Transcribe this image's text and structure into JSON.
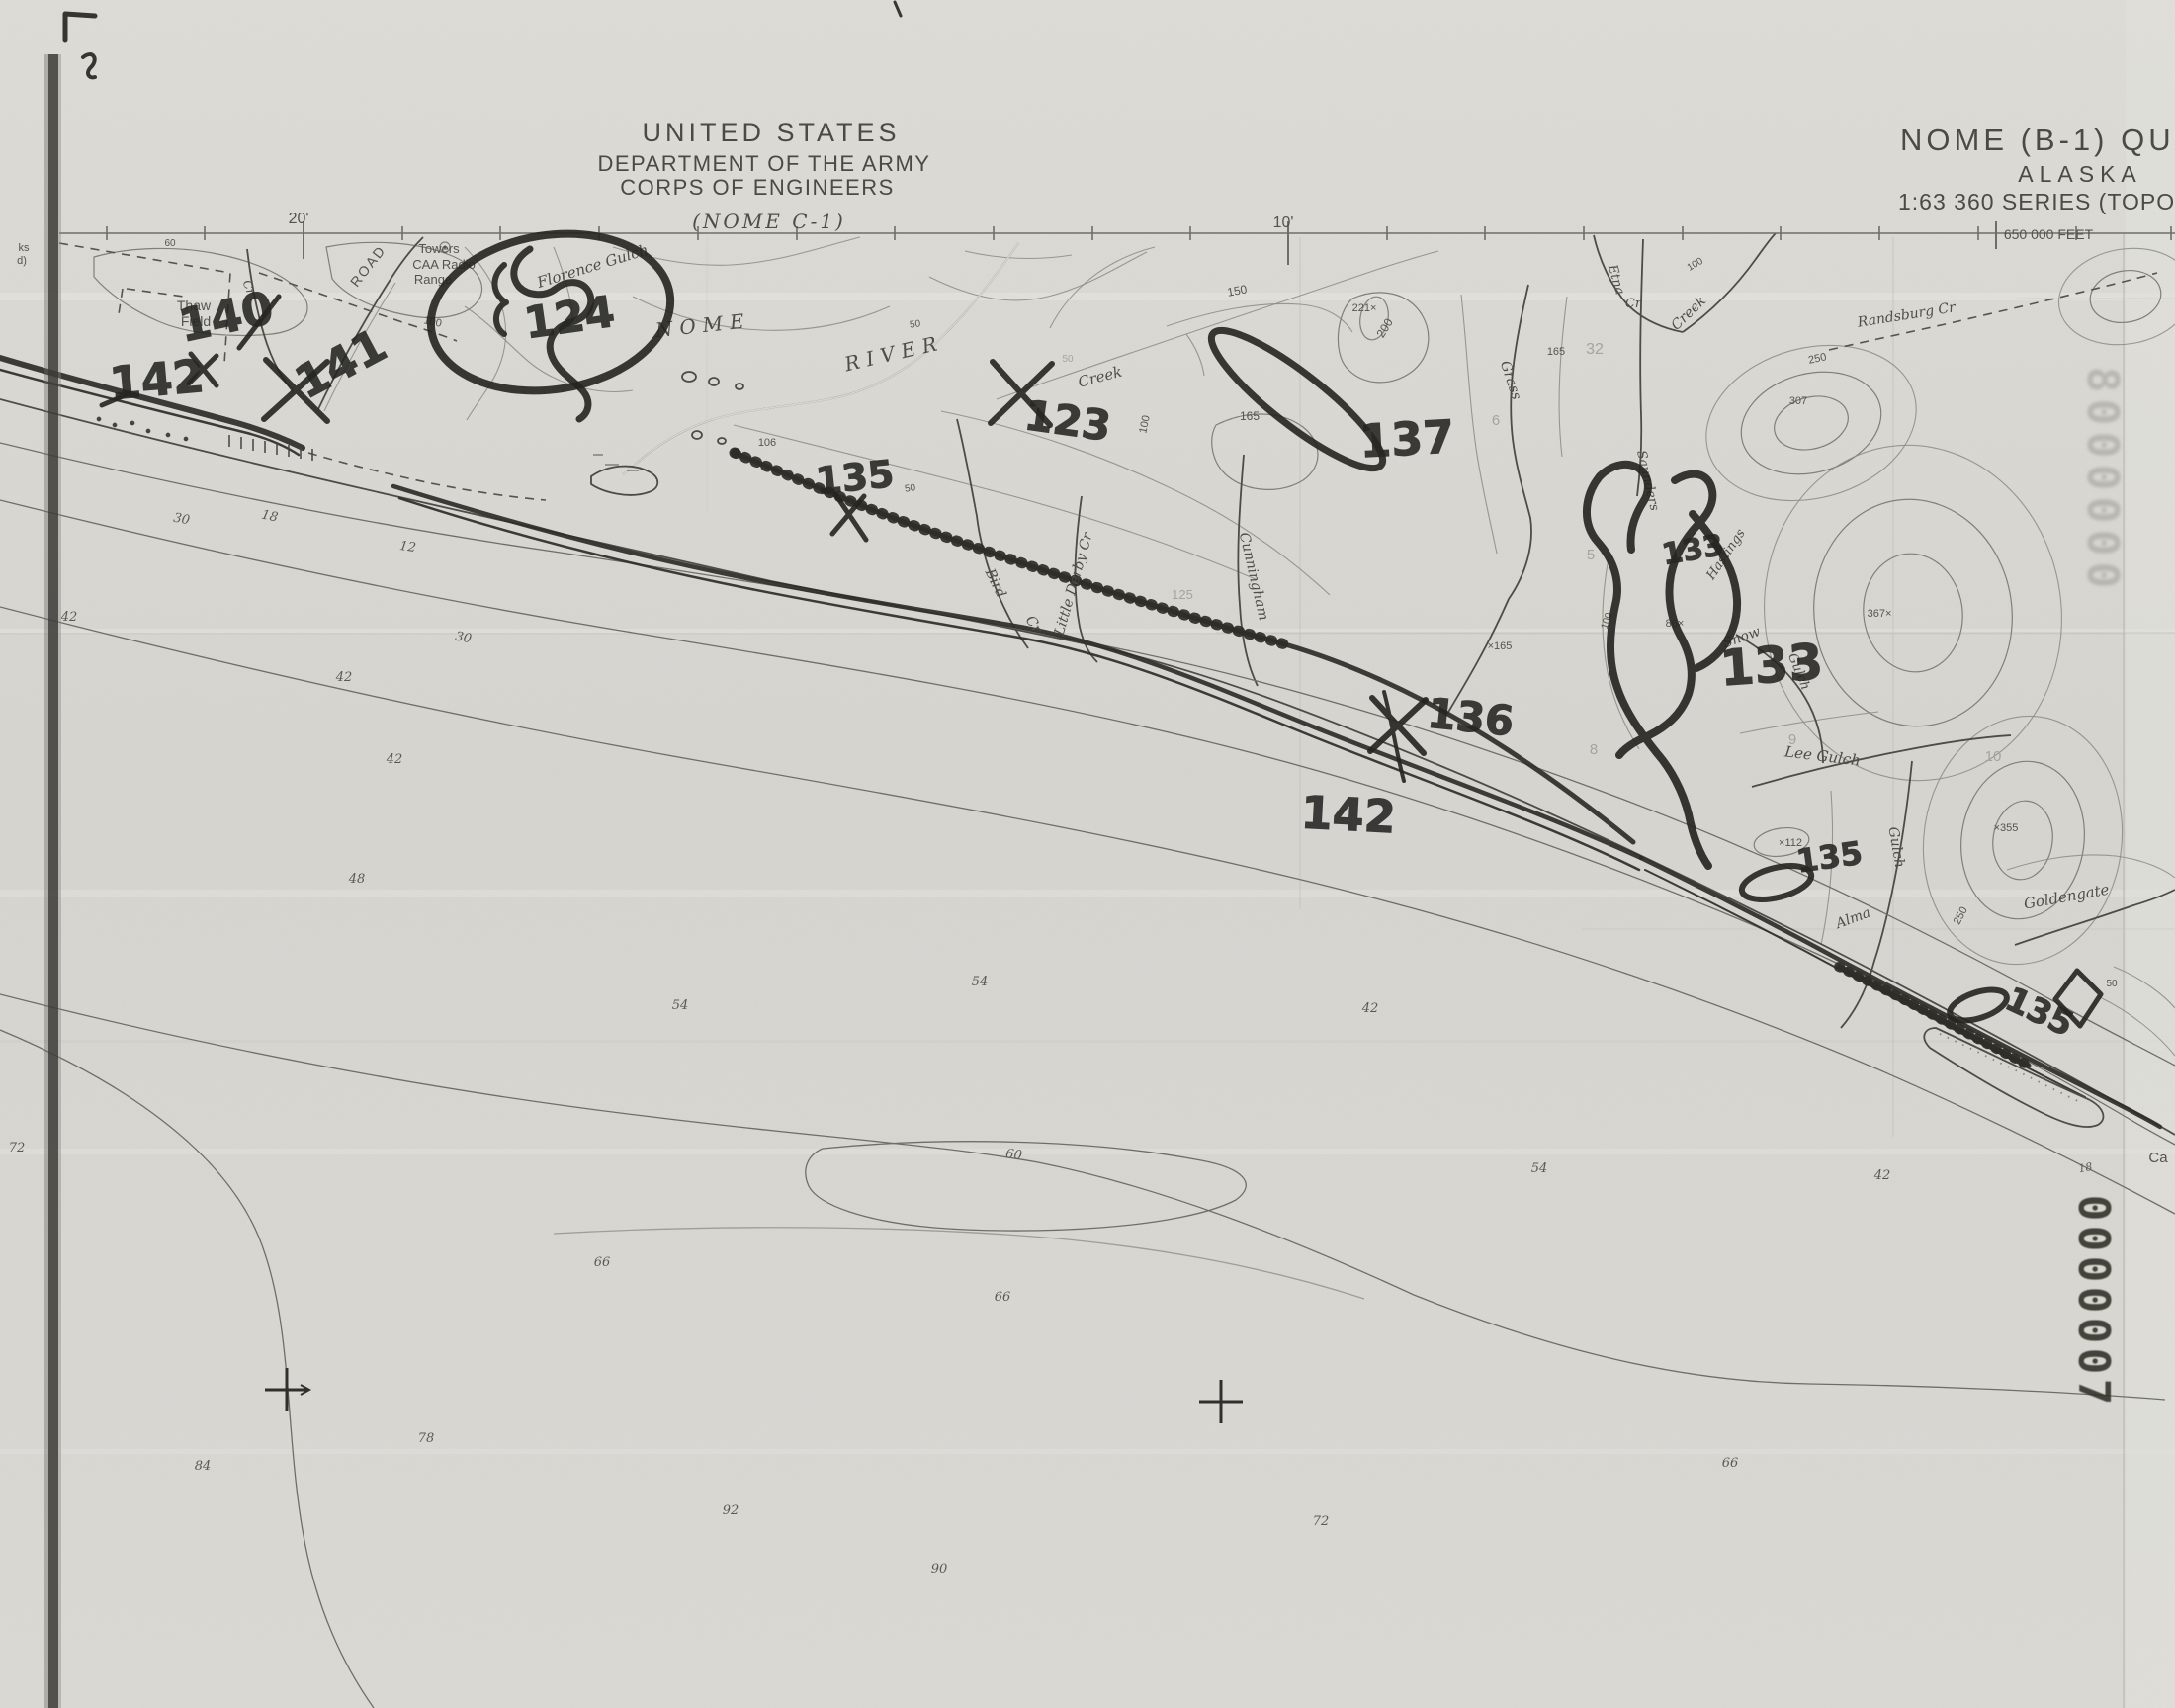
{
  "header": {
    "line1": "UNITED STATES",
    "line2": "DEPARTMENT OF THE ARMY",
    "line3": "CORPS OF ENGINEERS",
    "sheet_ref": "(NOME C-1)"
  },
  "title_block": {
    "quad": "NOME (B-1) QUADRA",
    "state": "ALASKA",
    "series": "1:63 360 SERIES (TOPOG",
    "feet_note": "650 000 FEET"
  },
  "neatline": {
    "tick_20": "20'",
    "tick_10": "10'"
  },
  "stamps": {
    "upper_faint": "8000000",
    "lower_dark": "0000007"
  },
  "colors": {
    "paper": "#dad9d4",
    "print_ink": "#55534c",
    "pen_ink": "#23221e",
    "faint": "#a6a59c"
  },
  "hand_annotations": [
    {
      "t": "140",
      "x": 232,
      "y": 336,
      "s": 46,
      "r": -12
    },
    {
      "t": "141",
      "x": 352,
      "y": 382,
      "s": 46,
      "r": -28
    },
    {
      "t": "142",
      "x": 160,
      "y": 400,
      "s": 46,
      "r": -5
    },
    {
      "t": "124",
      "x": 578,
      "y": 336,
      "s": 44,
      "r": -8
    },
    {
      "t": "135",
      "x": 866,
      "y": 496,
      "s": 38,
      "r": -6
    },
    {
      "t": "123",
      "x": 1078,
      "y": 440,
      "s": 42,
      "r": 8
    },
    {
      "t": "137",
      "x": 1424,
      "y": 460,
      "s": 46,
      "r": -3
    },
    {
      "t": "133",
      "x": 1714,
      "y": 566,
      "s": 30,
      "r": -10
    },
    {
      "t": "133",
      "x": 1793,
      "y": 690,
      "s": 50,
      "r": -4
    },
    {
      "t": "136",
      "x": 1486,
      "y": 740,
      "s": 42,
      "r": 6
    },
    {
      "t": "142",
      "x": 1363,
      "y": 840,
      "s": 46,
      "r": 3
    },
    {
      "t": "135",
      "x": 1852,
      "y": 878,
      "s": 32,
      "r": -8
    },
    {
      "t": "135",
      "x": 2058,
      "y": 1034,
      "s": 34,
      "r": 25
    }
  ],
  "map_labels": [
    {
      "t": "Thaw",
      "x": 196,
      "y": 314,
      "s": 14
    },
    {
      "t": "Field",
      "x": 198,
      "y": 330,
      "s": 14
    },
    {
      "t": "ROAD",
      "x": 376,
      "y": 272,
      "s": 14,
      "r": -52,
      "ls": 2
    },
    {
      "t": "Towers",
      "x": 444,
      "y": 256,
      "s": 13
    },
    {
      "t": "CAA Radio",
      "x": 449,
      "y": 272,
      "s": 13
    },
    {
      "t": "Range",
      "x": 438,
      "y": 287,
      "s": 13
    },
    {
      "t": "100",
      "x": 437,
      "y": 329,
      "s": 11,
      "r": 12
    },
    {
      "t": "Florence Gulch",
      "x": 601,
      "y": 274,
      "s": 15,
      "r": -17,
      "c": "ser"
    },
    {
      "t": "NOME",
      "x": 712,
      "y": 336,
      "s": 20,
      "r": -6,
      "c": "ser",
      "ls": 7
    },
    {
      "t": "RIVER",
      "x": 906,
      "y": 364,
      "s": 20,
      "r": -13,
      "c": "ser",
      "ls": 7
    },
    {
      "t": "Creek",
      "x": 1114,
      "y": 386,
      "s": 15,
      "r": -15,
      "c": "ser"
    },
    {
      "t": "106",
      "x": 776,
      "y": 451,
      "s": 11
    },
    {
      "t": "50",
      "x": 926,
      "y": 331,
      "s": 10,
      "r": -8
    },
    {
      "t": "50",
      "x": 921,
      "y": 497,
      "s": 10,
      "r": -8
    },
    {
      "t": "50",
      "x": 1080,
      "y": 366,
      "s": 10,
      "c": "fnt"
    },
    {
      "t": "100",
      "x": 1161,
      "y": 430,
      "s": 11,
      "r": -78
    },
    {
      "t": "Bird",
      "x": 1003,
      "y": 592,
      "s": 14,
      "r": 64,
      "c": "ser"
    },
    {
      "t": "Cr",
      "x": 1042,
      "y": 634,
      "s": 14,
      "r": 55,
      "c": "ser"
    },
    {
      "t": "Little Derby Cr",
      "x": 1090,
      "y": 592,
      "s": 14,
      "r": -74,
      "c": "ser"
    },
    {
      "t": "Cunningham",
      "x": 1264,
      "y": 584,
      "s": 14,
      "r": 77,
      "c": "ser"
    },
    {
      "t": "125",
      "x": 1196,
      "y": 606,
      "s": 13,
      "c": "fnt"
    },
    {
      "t": "150",
      "x": 1252,
      "y": 298,
      "s": 12,
      "r": -10
    },
    {
      "t": "221×",
      "x": 1380,
      "y": 315,
      "s": 11
    },
    {
      "t": "200",
      "x": 1404,
      "y": 334,
      "s": 12,
      "r": -58
    },
    {
      "t": "165",
      "x": 1264,
      "y": 425,
      "s": 12
    },
    {
      "t": "Grass",
      "x": 1524,
      "y": 386,
      "s": 14,
      "r": 72,
      "c": "ser"
    },
    {
      "t": "165",
      "x": 1574,
      "y": 359,
      "s": 11
    },
    {
      "t": "32",
      "x": 1613,
      "y": 358,
      "s": 16,
      "c": "fnt"
    },
    {
      "t": "×165",
      "x": 1517,
      "y": 657,
      "s": 11
    },
    {
      "t": "Etna",
      "x": 1631,
      "y": 284,
      "s": 13,
      "r": 74,
      "c": "ser"
    },
    {
      "t": "Cr",
      "x": 1652,
      "y": 311,
      "s": 13,
      "c": "ser"
    },
    {
      "t": "Creek",
      "x": 1711,
      "y": 320,
      "s": 14,
      "r": -44,
      "c": "ser"
    },
    {
      "t": "100",
      "x": 1716,
      "y": 270,
      "s": 10,
      "r": -30
    },
    {
      "t": "Randsburg Cr",
      "x": 1929,
      "y": 323,
      "s": 14,
      "r": -9,
      "c": "ser"
    },
    {
      "t": "250",
      "x": 1839,
      "y": 366,
      "s": 11,
      "r": -12
    },
    {
      "t": "307",
      "x": 1819,
      "y": 409,
      "s": 11
    },
    {
      "t": "Saunders",
      "x": 1663,
      "y": 487,
      "s": 13,
      "r": 77,
      "c": "ser"
    },
    {
      "t": "Hastings",
      "x": 1749,
      "y": 563,
      "s": 13,
      "r": -56,
      "c": "ser"
    },
    {
      "t": "86×",
      "x": 1694,
      "y": 634,
      "s": 11
    },
    {
      "t": "100",
      "x": 1628,
      "y": 629,
      "s": 10,
      "r": -72
    },
    {
      "t": "367×",
      "x": 1901,
      "y": 624,
      "s": 11
    },
    {
      "t": "Snow",
      "x": 1763,
      "y": 649,
      "s": 14,
      "r": -20,
      "c": "ser"
    },
    {
      "t": "Gulch",
      "x": 1816,
      "y": 681,
      "s": 13,
      "r": 68,
      "c": "ser"
    },
    {
      "t": "Lee Gulch",
      "x": 1843,
      "y": 770,
      "s": 15,
      "r": 7,
      "c": "ser"
    },
    {
      "t": "Gulch",
      "x": 1914,
      "y": 858,
      "s": 14,
      "r": 80,
      "c": "ser"
    },
    {
      "t": "Alma",
      "x": 1876,
      "y": 933,
      "s": 14,
      "r": -20,
      "c": "ser"
    },
    {
      "t": "×112",
      "x": 1811,
      "y": 856,
      "s": 11
    },
    {
      "t": "×355",
      "x": 2029,
      "y": 841,
      "s": 11
    },
    {
      "t": "250",
      "x": 1986,
      "y": 928,
      "s": 11,
      "r": -62
    },
    {
      "t": "Goldengate",
      "x": 2091,
      "y": 912,
      "s": 15,
      "r": -10,
      "c": "ser"
    },
    {
      "t": "Ca",
      "x": 2183,
      "y": 1176,
      "s": 15
    },
    {
      "t": "18",
      "x": 2110,
      "y": 1185,
      "s": 11,
      "r": -10,
      "c": "dep"
    },
    {
      "t": "50",
      "x": 2136,
      "y": 998,
      "s": 10
    },
    {
      "t": "Cr",
      "x": 248,
      "y": 292,
      "s": 12,
      "r": 70,
      "c": "ser"
    },
    {
      "t": "60",
      "x": 172,
      "y": 249,
      "s": 10
    },
    {
      "t": "ks",
      "x": 24,
      "y": 254,
      "s": 11
    },
    {
      "t": "d)",
      "x": 22,
      "y": 267,
      "s": 11
    },
    {
      "t": "5",
      "x": 1609,
      "y": 566,
      "s": 15,
      "c": "fnt"
    },
    {
      "t": "8",
      "x": 1612,
      "y": 763,
      "s": 15,
      "c": "fnt"
    },
    {
      "t": "9",
      "x": 1813,
      "y": 753,
      "s": 15,
      "c": "fnt"
    },
    {
      "t": "10",
      "x": 2016,
      "y": 770,
      "s": 15,
      "c": "fnt"
    },
    {
      "t": "6",
      "x": 1513,
      "y": 430,
      "s": 15,
      "c": "fnt"
    }
  ],
  "depth_labels": [
    {
      "t": "42",
      "x": 70,
      "y": 628
    },
    {
      "t": "30",
      "x": 183,
      "y": 529,
      "r": 10
    },
    {
      "t": "18",
      "x": 272,
      "y": 526,
      "r": 12
    },
    {
      "t": "12",
      "x": 412,
      "y": 557,
      "r": 8
    },
    {
      "t": "30",
      "x": 468,
      "y": 649,
      "r": 10
    },
    {
      "t": "42",
      "x": 348,
      "y": 689
    },
    {
      "t": "42",
      "x": 399,
      "y": 772
    },
    {
      "t": "48",
      "x": 361,
      "y": 893
    },
    {
      "t": "54",
      "x": 688,
      "y": 1021
    },
    {
      "t": "54",
      "x": 991,
      "y": 997
    },
    {
      "t": "42",
      "x": 1386,
      "y": 1024
    },
    {
      "t": "60",
      "x": 1025,
      "y": 1172,
      "r": 8
    },
    {
      "t": "54",
      "x": 1557,
      "y": 1186
    },
    {
      "t": "42",
      "x": 1904,
      "y": 1193
    },
    {
      "t": "66",
      "x": 609,
      "y": 1281
    },
    {
      "t": "66",
      "x": 1014,
      "y": 1316
    },
    {
      "t": "72",
      "x": 17,
      "y": 1165
    },
    {
      "t": "78",
      "x": 431,
      "y": 1459
    },
    {
      "t": "84",
      "x": 205,
      "y": 1487
    },
    {
      "t": "92",
      "x": 739,
      "y": 1532
    },
    {
      "t": "90",
      "x": 950,
      "y": 1591
    },
    {
      "t": "72",
      "x": 1336,
      "y": 1543
    },
    {
      "t": "66",
      "x": 1750,
      "y": 1484
    }
  ]
}
